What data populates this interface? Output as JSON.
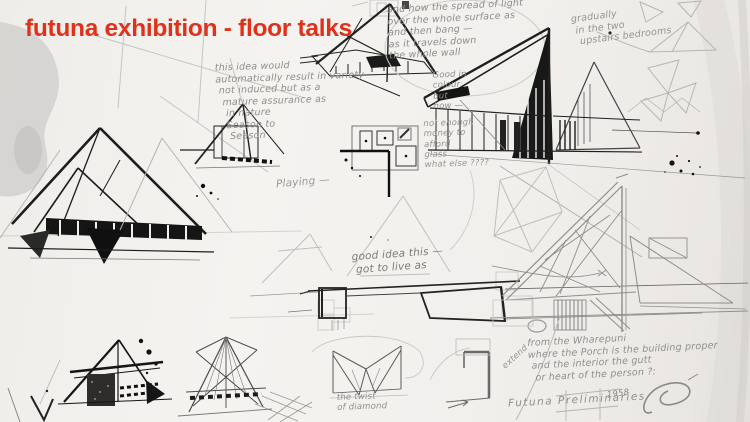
{
  "slide": {
    "title": "futuna exhibition - floor talks"
  },
  "colors": {
    "title_red": "#e0321a",
    "ink": "#1c1c1c",
    "pencil": "#9b9b9b",
    "paper": "#f2f0ed"
  },
  "annotations": [
    {
      "id": "note-light-spread",
      "text": "and how the spread of light\nover the whole surface as\nand then bang —\nas it travels down\nthe whole wall"
    },
    {
      "id": "note-gradually",
      "text": "gradually\n in the two\n  upstairs bedrooms"
    },
    {
      "id": "note-good-colour",
      "text": "Good in\ncolour\nbut\nhow —"
    },
    {
      "id": "note-materials",
      "text": "not enough\nmoney to\nafford\nglass\nwhat else ????"
    },
    {
      "id": "note-idea-variety",
      "text": "this idea would\nautomatically result in variety\n not induced but as a\n  mature assurance as\n   in nature\n   Season to\n    Season"
    },
    {
      "id": "note-playing",
      "text": "Playing —"
    },
    {
      "id": "note-got-to-live",
      "text": "good idea this —\n got to live as"
    },
    {
      "id": "note-wharepuni",
      "text": "from the Wharepuni\nwhere the Porch is the building proper\n and the interior the gutt\n  or heart of the person ?:"
    },
    {
      "id": "note-extend",
      "text": "extend"
    },
    {
      "id": "note-twist",
      "text": "the twist\nof diamond"
    }
  ],
  "footer": {
    "caption": "Futuna Preliminaries",
    "year": "1958",
    "signature": "JS signature flourish"
  }
}
